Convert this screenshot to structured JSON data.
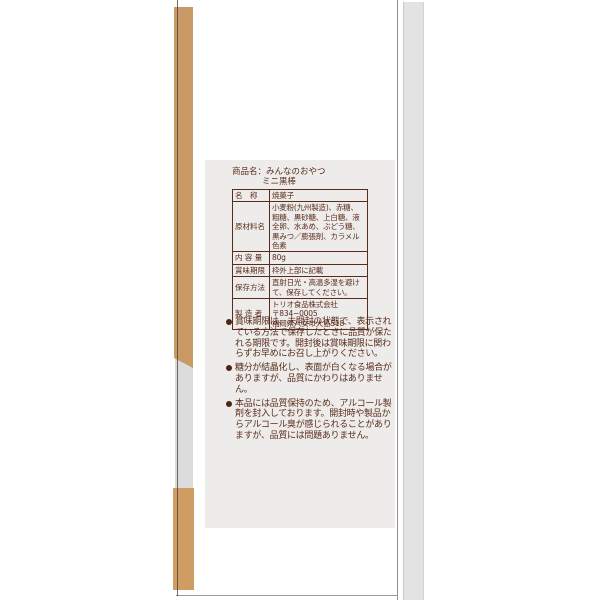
{
  "colors": {
    "package_tan": "#c99a66",
    "package_tan_bottom": "#cf9c63",
    "side_strip_gray": "#dcdcdd",
    "right_strip_gray": "#e3e3e3",
    "label_panel_bg": "#edecea",
    "label_text_brown": "#5a2c1b"
  },
  "label": {
    "product_name": {
      "prefix": "商品名：",
      "line1": "みんなのおやつ",
      "line2": "ミニ黒棒"
    },
    "spec_table": {
      "rows": [
        {
          "label": "名　称",
          "value": "焼菓子"
        },
        {
          "label": "原材料名",
          "value": "小麦粉(九州製造)、赤糖、粗糖、黒砂糖、上白糖、液全卵、水あめ、ぶどう糖、黒みつ／膨張剤、カラメル色素"
        },
        {
          "label": "内 容 量",
          "value": "80g"
        },
        {
          "label": "賞味期限",
          "value": "枠外上部に記載"
        },
        {
          "label": "保存方法",
          "value": "直射日光・高温多湿を避けて、保存してください。"
        },
        {
          "label": "製 造 者",
          "value": "トリオ食品株式会社\n〒834−0005\n福岡県八女市大島518"
        }
      ]
    },
    "notes": [
      "賞味期限は、未開封の状態で、表示されている方法で保存したときに品質が保たれる期限です。開封後は賞味期限に関わらずお早めにお召し上がりください。",
      "糖分が結晶化し、表面が白くなる場合がありますが、品質にかわりはありません。",
      "本品には品質保持のため、アルコール製剤を封入しております。開封時や製品からアルコール臭が感じられることがありますが、品質には問題ありません。"
    ]
  }
}
